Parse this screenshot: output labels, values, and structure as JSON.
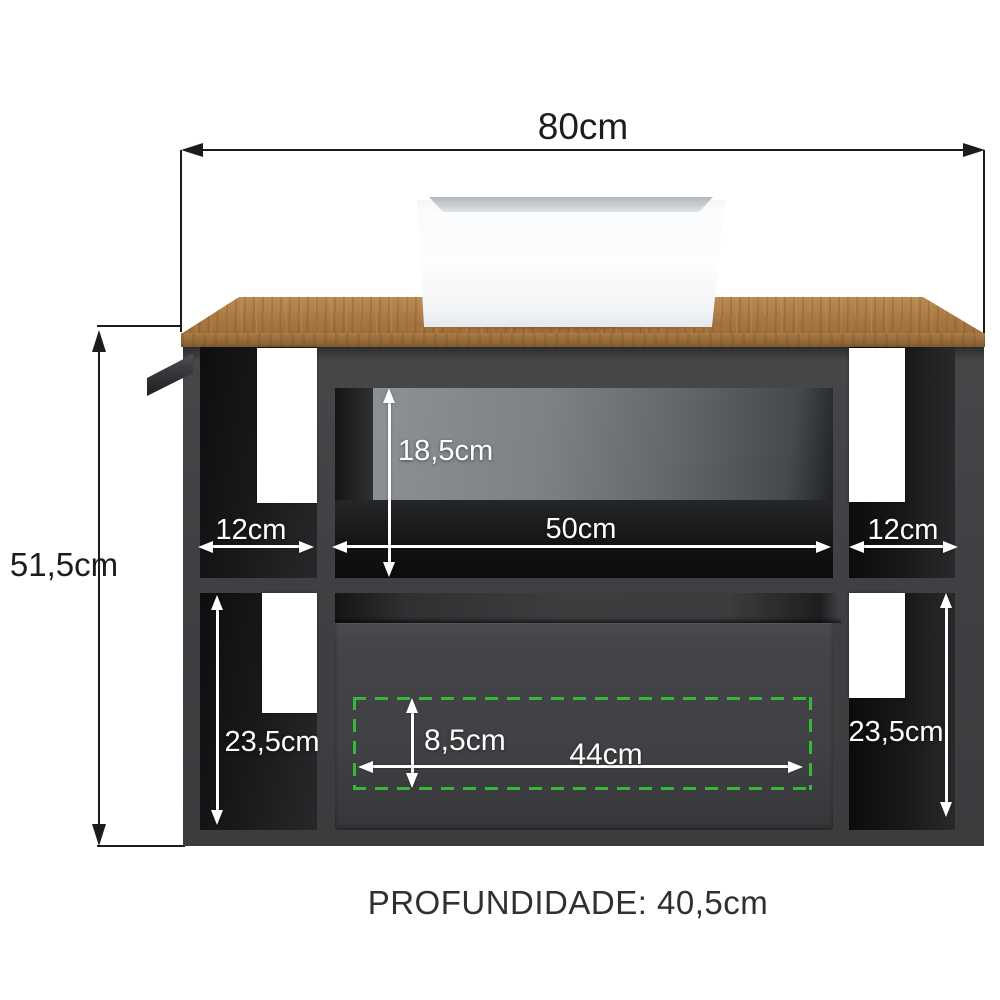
{
  "product": {
    "description": "bathroom vanity cabinet with wood countertop and square vessel basin",
    "colors": {
      "background": "#ffffff",
      "cabinet_charcoal": "#3e4043",
      "countertop_wood": "#aa7a44",
      "basin_white": "#fdfdfe",
      "dimension_black": "#1c1c1c",
      "annotation_white": "#ffffff",
      "clearance_green": "#38b638"
    }
  },
  "dimensions": {
    "overall_width": "80cm",
    "overall_height": "51,5cm",
    "niche_height": "18,5cm",
    "left_shelf_width": "12cm",
    "niche_width": "50cm",
    "right_shelf_width": "12cm",
    "left_lower_height": "23,5cm",
    "right_lower_height": "23,5cm",
    "drawer_clearance_height": "8,5cm",
    "drawer_clearance_width": "44cm"
  },
  "footer": {
    "depth_label": "PROFUNDIDADE: 40,5cm"
  }
}
